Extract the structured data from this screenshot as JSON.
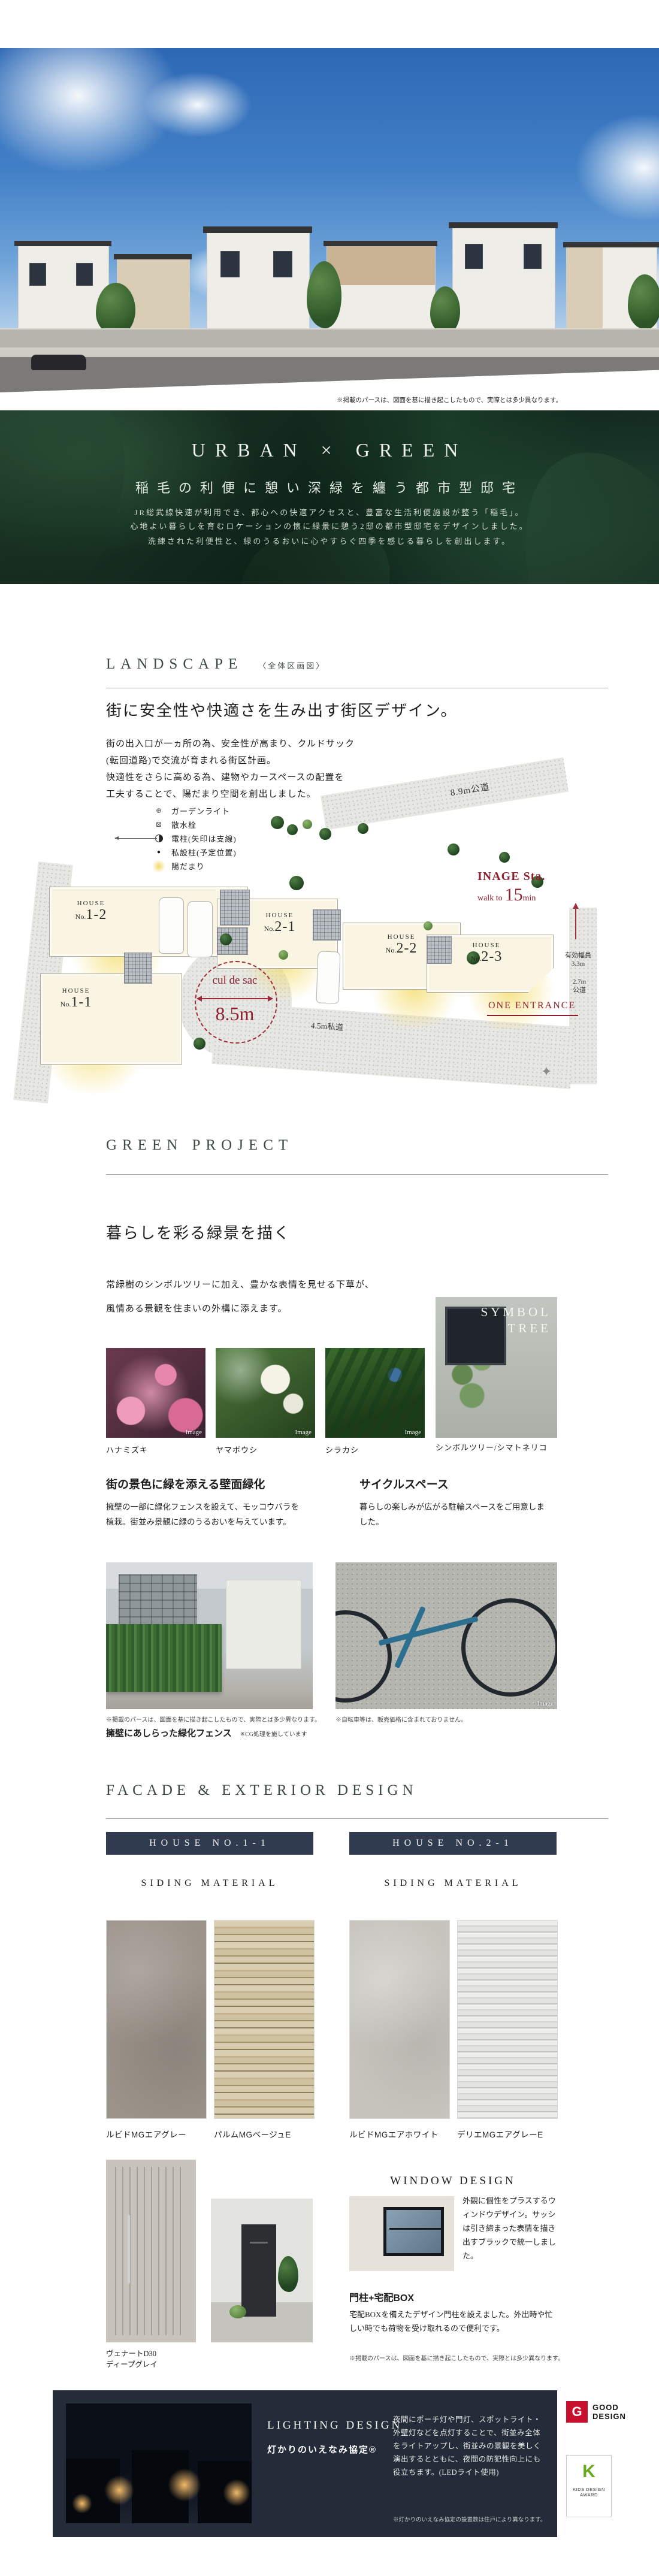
{
  "hero": {
    "caption": "※掲載のパースは、図面を基に描き起こしたもので、実際とは多少異なります。"
  },
  "urban_green": {
    "title": "URBAN × GREEN",
    "subtitle": "稲毛の利便に憩い深緑を纏う都市型邸宅",
    "body_lines": [
      "JR総武線快速が利用でき、都心への快適アクセスと、豊富な生活利便施設が整う「稲毛」。",
      "心地よい暮らしを育むロケーションの懐に緑景に憩う2邸の都市型邸宅をデザインしました。",
      "洗練された利便性と、緑のうるおいに心やすらぐ四季を感じる暮らしを創出します。"
    ]
  },
  "landscape": {
    "title": "LANDSCAPE",
    "title_note": "〈全体区画図〉",
    "heading": "街に安全性や快適さを生み出す街区デザイン。",
    "body_lines": [
      "街の出入口が一ヵ所の為、安全性が高まり、クルドサック",
      "(転回道路)で交流が育まれる街区計画。",
      "快適性をさらに高める為、建物やカースペースの配置を",
      "工夫することで、陽だまり空間を創出しました。"
    ],
    "legend": [
      {
        "label": "ガーデンライト"
      },
      {
        "label": "散水栓"
      },
      {
        "label": "電柱(矢印は支線)"
      },
      {
        "label": "私設柱(予定位置)"
      },
      {
        "label": "陽だまり"
      }
    ],
    "plan": {
      "road_top": "8.9m公道",
      "road_private": "4.5m私道",
      "width_note1a": "有効幅員",
      "width_note1b": "3.3m",
      "width_note2a": "2.7m",
      "width_note2b": "公道",
      "station_name": "INAGE Sta.",
      "station_walk": "walk to",
      "station_min": "15",
      "station_unit": "min",
      "entrance": "ONE ENTRANCE",
      "culdesac": "cul de sac",
      "culdesac_width": "8.5m",
      "houses": [
        {
          "line1": "HOUSE",
          "no_prefix": "No.",
          "no": "1-2"
        },
        {
          "line1": "HOUSE",
          "no_prefix": "No.",
          "no": "1-1"
        },
        {
          "line1": "HOUSE",
          "no_prefix": "No.",
          "no": "2-1"
        },
        {
          "line1": "HOUSE",
          "no_prefix": "No.",
          "no": "2-2"
        },
        {
          "line1": "HOUSE",
          "no_prefix": "No.",
          "no": "2-3"
        }
      ]
    }
  },
  "green_project": {
    "title": "GREEN PROJECT",
    "heading": "暮らしを彩る緑景を描く",
    "body_lines": [
      "常緑樹のシンボルツリーに加え、豊かな表情を見せる下草が、",
      "風情ある景観を住まいの外構に添えます。"
    ],
    "photos": [
      {
        "caption": "ハナミズキ",
        "tag": "Image"
      },
      {
        "caption": "ヤマボウシ",
        "tag": "Image"
      },
      {
        "caption": "シラカシ",
        "tag": "Image"
      }
    ],
    "symbol_tree": {
      "overlay_line1": "SYMBOL",
      "overlay_line2": "TREE",
      "caption": "シンボルツリー/シマトネリコ"
    },
    "wall_green": {
      "heading": "街の景色に緑を添える壁面緑化",
      "body": "擁壁の一部に緑化フェンスを設えて、モッコウバラを植栽。街並み景観に緑のうるおいを与えています。",
      "note": "※掲載のパースは、図面を基に描き起こしたもので、実際とは多少異なります。",
      "caption": "擁壁にあしらった緑化フェンス",
      "caption_note": "※CG処理を施しています"
    },
    "cycle_space": {
      "heading": "サイクルスペース",
      "body": "暮らしの楽しみが広がる駐輪スペースをご用意しました。",
      "note": "※自転車等は、販売価格に含まれておりません。",
      "tag": "Image"
    }
  },
  "facade": {
    "title": "FACADE & EXTERIOR DESIGN",
    "columns": [
      {
        "header": "HOUSE NO.1-1",
        "sub": "SIDING MATERIAL",
        "swatches": [
          {
            "name": "ルビドMGエアグレー"
          },
          {
            "name": "パルムMGベージュE"
          }
        ]
      },
      {
        "header": "HOUSE NO.2-1",
        "sub": "SIDING MATERIAL",
        "swatches": [
          {
            "name": "ルビドMGエアホワイト"
          },
          {
            "name": "デリエMGエアグレーE"
          }
        ]
      }
    ],
    "door_caption_line1": "ヴェナートD30",
    "door_caption_line2": "ディープグレイ",
    "window_design": {
      "title": "WINDOW DESIGN",
      "body": "外観に個性をプラスするウィンドウデザイン。サッシは引き締まった表情を描き出すブラックで統一しました。"
    },
    "gate_box": {
      "title": "門柱+宅配BOX",
      "body": "宅配BOXを備えたデザイン門柱を設えました。外出時や忙しい時でも荷物を受け取れるので便利です。"
    },
    "note": "※掲載のパースは、図面を基に描き起こしたもので、実際とは多少異なります。"
  },
  "lighting": {
    "title": "LIGHTING DESIGN",
    "subtitle": "灯かりのいえなみ協定®",
    "body": "夜間にポーチ灯や門灯、スポットライト・外壁灯などを点灯することで、街並み全体をライトアップし、街並みの景観を美しく演出するとともに、夜間の防犯性向上にも役立ちます。(LEDライト使用)",
    "note": "※灯かりのいえなみ協定の設置数は住戸により異なります。",
    "awards": [
      {
        "mark": "G",
        "line1": "GOOD",
        "line2": "DESIGN"
      },
      {
        "mark": "K",
        "line1": "KIDS DESIGN",
        "line2": "AWARD"
      }
    ]
  },
  "colors": {
    "accent_red": "#8e1f2f",
    "navy": "#313b50",
    "dark_green": "#0e2318",
    "good_design_red": "#c8102e",
    "kids_design_green": "#6aaa1e"
  }
}
